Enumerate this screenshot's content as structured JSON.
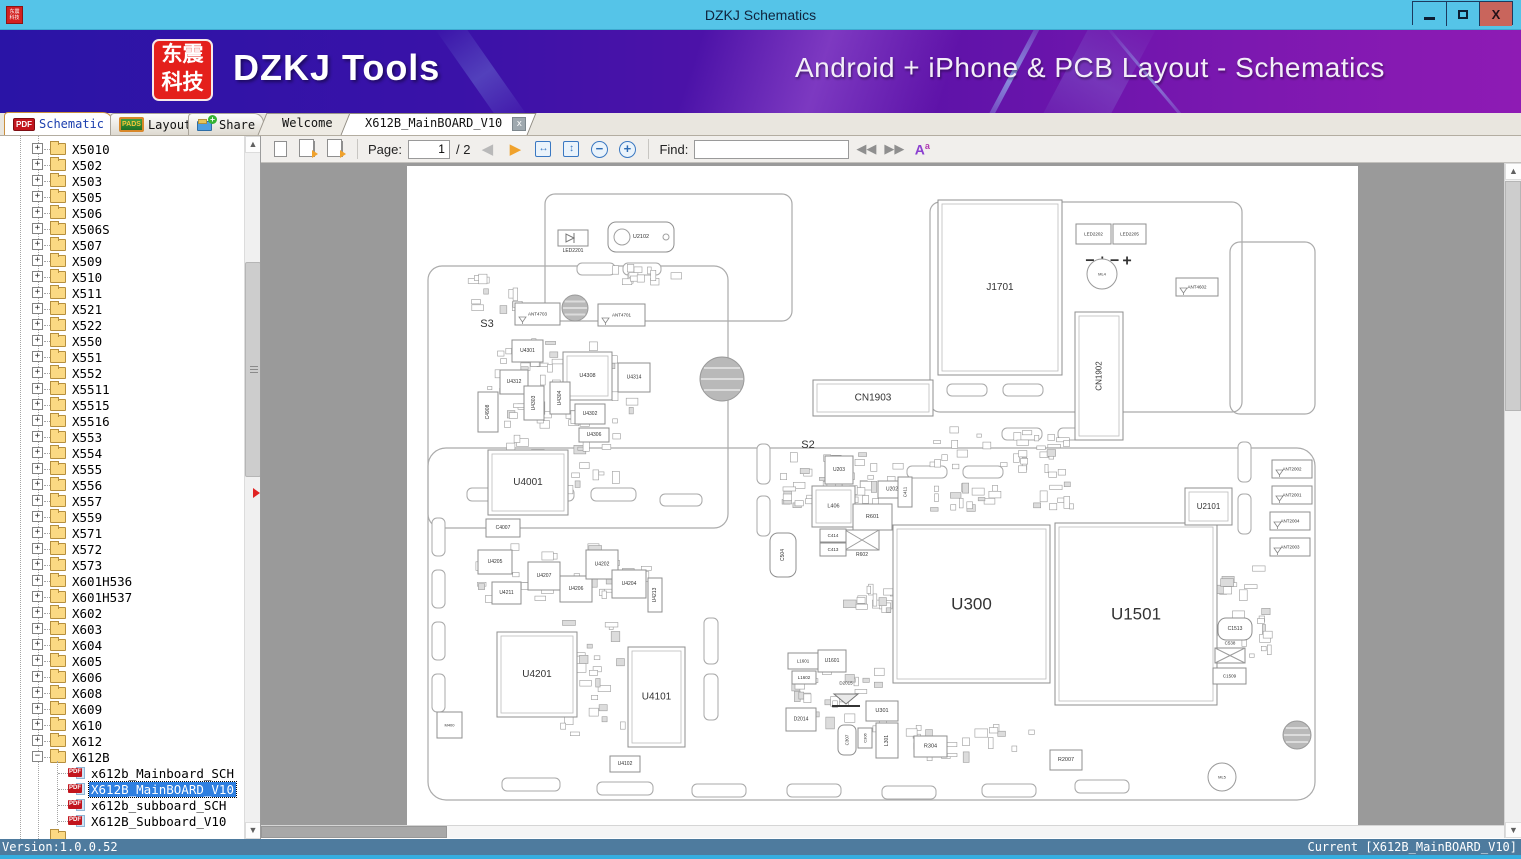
{
  "window": {
    "title": "DZKJ Schematics",
    "minimize": "–",
    "maximize": "□",
    "close": "X"
  },
  "banner": {
    "logo_line1": "东震",
    "logo_line2": "科技",
    "title": "DZKJ Tools",
    "subtitle": "Android + iPhone & PCB Layout - Schematics"
  },
  "nav_tabs": {
    "pdf_badge": "PDF",
    "schematic": "Schematic",
    "pads_badge": "PADS",
    "layout": "Layout",
    "share": "Share"
  },
  "doc_tabs": {
    "welcome": "Welcome",
    "active": "X612B_MainBOARD_V10",
    "close_glyph": "x"
  },
  "toolbar": {
    "page_label": "Page:",
    "page_value": "1",
    "page_total": "/ 2",
    "find_label": "Find:",
    "find_value": "",
    "fit_width_glyph": "↔",
    "fit_page_glyph": "↕",
    "zoom_out_glyph": "−",
    "zoom_in_glyph": "+",
    "prev_glyph": "◀",
    "next_glyph": "▶",
    "find_prev_glyph": "◀◀",
    "find_next_glyph": "▶▶",
    "case_glyph": "A"
  },
  "sidebar": {
    "folders": [
      "X5010",
      "X502",
      "X503",
      "X505",
      "X506",
      "X506S",
      "X507",
      "X509",
      "X510",
      "X511",
      "X521",
      "X522",
      "X550",
      "X551",
      "X552",
      "X5511",
      "X5515",
      "X5516",
      "X553",
      "X554",
      "X555",
      "X556",
      "X557",
      "X559",
      "X571",
      "X572",
      "X573",
      "X601H536",
      "X601H537",
      "X602",
      "X603",
      "X604",
      "X605",
      "X606",
      "X608",
      "X609",
      "X610",
      "X612",
      "X612B"
    ],
    "expanded": "X612B",
    "children": [
      "x612b_Mainboard_SCH",
      "X612B_MainBOARD_V10",
      "x612b_subboard_SCH",
      "X612B_Subboard_V10"
    ],
    "selected": "X612B_MainBOARD_V10"
  },
  "statusbar": {
    "version": "Version:1.0.0.52",
    "current": "Current [X612B_MainBOARD_V10]"
  },
  "colors": {
    "titlebar": "#55c4e8",
    "close_btn": "#c9655c",
    "selection": "#2e7fe0",
    "status": "#4e7b9e",
    "accent_strip": "#35aee0",
    "viewer_bg": "#9a9a9a",
    "logo_red": "#e4201c"
  },
  "board": {
    "outlines": [
      [
        138,
        28,
        247,
        127,
        10
      ],
      [
        21,
        100,
        300,
        262,
        14
      ],
      [
        523,
        36,
        312,
        210,
        10
      ],
      [
        823,
        76,
        85,
        172,
        10
      ],
      [
        21,
        282,
        887,
        352,
        18
      ]
    ],
    "slots": [
      [
        60,
        322,
        45,
        13
      ],
      [
        122,
        322,
        45,
        13
      ],
      [
        184,
        322,
        45,
        13
      ],
      [
        253,
        328,
        42,
        12
      ],
      [
        170,
        97,
        38,
        12
      ],
      [
        216,
        97,
        38,
        12
      ],
      [
        540,
        218,
        40,
        12
      ],
      [
        596,
        218,
        40,
        12
      ],
      [
        25,
        352,
        13,
        38
      ],
      [
        25,
        404,
        13,
        38
      ],
      [
        25,
        456,
        13,
        38
      ],
      [
        25,
        508,
        13,
        38
      ],
      [
        95,
        612,
        58,
        13
      ],
      [
        190,
        616,
        56,
        13
      ],
      [
        285,
        618,
        54,
        13
      ],
      [
        380,
        618,
        54,
        13
      ],
      [
        475,
        620,
        54,
        13
      ],
      [
        575,
        618,
        54,
        13
      ],
      [
        668,
        614,
        54,
        13
      ],
      [
        350,
        278,
        13,
        40
      ],
      [
        350,
        330,
        13,
        40
      ],
      [
        500,
        300,
        40,
        12
      ],
      [
        556,
        300,
        40,
        12
      ],
      [
        831,
        276,
        13,
        40
      ],
      [
        831,
        328,
        13,
        40
      ],
      [
        297,
        452,
        14,
        46
      ],
      [
        297,
        508,
        14,
        46
      ],
      [
        595,
        262,
        40,
        12
      ],
      [
        651,
        262,
        40,
        12
      ]
    ],
    "screws": [
      {
        "cx": 168,
        "cy": 142,
        "r": 13
      },
      {
        "cx": 315,
        "cy": 213,
        "r": 22
      },
      {
        "cx": 890,
        "cy": 569,
        "r": 14
      }
    ],
    "marks": [
      {
        "t": "ML4",
        "cx": 695,
        "cy": 108,
        "r": 15
      },
      {
        "t": "ML5",
        "cx": 815,
        "cy": 611,
        "r": 14
      }
    ],
    "ovals": [
      [
        551,
        62
      ],
      [
        634,
        88
      ],
      [
        551,
        170
      ],
      [
        634,
        170
      ]
    ],
    "labels": [
      {
        "t": "S3",
        "x": 80,
        "y": 158,
        "fs": 11
      },
      {
        "t": "S2",
        "x": 401,
        "y": 279,
        "fs": 11
      }
    ],
    "polarity": {
      "t": "−+−+",
      "x": 703,
      "y": 95,
      "fs": 16
    },
    "components": [
      {
        "t": "J1701",
        "x": 531,
        "y": 34,
        "w": 124,
        "h": 175,
        "fs": 10,
        "shape": "rect2"
      },
      {
        "t": "U300",
        "x": 486,
        "y": 359,
        "w": 157,
        "h": 158,
        "fs": 17,
        "shape": "rect2"
      },
      {
        "t": "U1501",
        "x": 648,
        "y": 357,
        "w": 162,
        "h": 182,
        "fs": 17,
        "shape": "rect2"
      },
      {
        "t": "U4001",
        "x": 81,
        "y": 284,
        "w": 80,
        "h": 65,
        "fs": 10,
        "shape": "rect2"
      },
      {
        "t": "U4201",
        "x": 90,
        "y": 466,
        "w": 80,
        "h": 85,
        "fs": 10,
        "shape": "rect2"
      },
      {
        "t": "U4101",
        "x": 221,
        "y": 481,
        "w": 57,
        "h": 100,
        "fs": 10,
        "shape": "rect2"
      },
      {
        "t": "CN1902",
        "x": 668,
        "y": 146,
        "w": 48,
        "h": 128,
        "fs": 8,
        "shape": "vrect2"
      },
      {
        "t": "CN1903",
        "x": 406,
        "y": 214,
        "w": 120,
        "h": 36,
        "fs": 10,
        "shape": "rect2"
      },
      {
        "t": "U2102",
        "x": 201,
        "y": 56,
        "w": 66,
        "h": 30,
        "fs": 5.5,
        "shape": "rrect"
      },
      {
        "t": "LED2201",
        "x": 151,
        "y": 64,
        "w": 30,
        "h": 16,
        "fs": 5,
        "shape": "led",
        "lp": "below"
      },
      {
        "t": "LED2202",
        "x": 669,
        "y": 58,
        "w": 35,
        "h": 20,
        "fs": 4.5,
        "shape": "rect"
      },
      {
        "t": "LED2205",
        "x": 706,
        "y": 58,
        "w": 33,
        "h": 20,
        "fs": 4.5,
        "shape": "rect"
      },
      {
        "t": "ANT4703",
        "x": 108,
        "y": 137,
        "w": 45,
        "h": 22,
        "fs": 4.5,
        "shape": "ant"
      },
      {
        "t": "ANT4701",
        "x": 191,
        "y": 138,
        "w": 47,
        "h": 22,
        "fs": 4.5,
        "shape": "ant"
      },
      {
        "t": "ANT4602",
        "x": 769,
        "y": 112,
        "w": 42,
        "h": 18,
        "fs": 4.5,
        "shape": "ant"
      },
      {
        "t": "ANT2002",
        "x": 865,
        "y": 294,
        "w": 40,
        "h": 18,
        "fs": 4.5,
        "shape": "ant"
      },
      {
        "t": "ANT2001",
        "x": 865,
        "y": 320,
        "w": 40,
        "h": 18,
        "fs": 4.5,
        "shape": "ant"
      },
      {
        "t": "ANT2004",
        "x": 863,
        "y": 346,
        "w": 40,
        "h": 18,
        "fs": 4.5,
        "shape": "ant"
      },
      {
        "t": "ANT2003",
        "x": 863,
        "y": 372,
        "w": 40,
        "h": 18,
        "fs": 4.5,
        "shape": "ant"
      },
      {
        "t": "U2101",
        "x": 778,
        "y": 322,
        "w": 47,
        "h": 37,
        "fs": 8,
        "shape": "rect2"
      },
      {
        "t": "U4301",
        "x": 105,
        "y": 174,
        "w": 31,
        "h": 22,
        "fs": 5,
        "shape": "rect"
      },
      {
        "t": "U4312",
        "x": 93,
        "y": 204,
        "w": 28,
        "h": 24,
        "fs": 5,
        "shape": "rect"
      },
      {
        "t": "U4308",
        "x": 156,
        "y": 186,
        "w": 49,
        "h": 48,
        "fs": 5.5,
        "shape": "rect2"
      },
      {
        "t": "U4314",
        "x": 211,
        "y": 197,
        "w": 32,
        "h": 29,
        "fs": 5,
        "shape": "rect"
      },
      {
        "t": "U4303",
        "x": 117,
        "y": 220,
        "w": 20,
        "h": 34,
        "fs": 5,
        "shape": "vrect"
      },
      {
        "t": "U4304",
        "x": 143,
        "y": 216,
        "w": 20,
        "h": 32,
        "fs": 5,
        "shape": "vrect"
      },
      {
        "t": "U4302",
        "x": 168,
        "y": 238,
        "w": 30,
        "h": 20,
        "fs": 5,
        "shape": "rect"
      },
      {
        "t": "U4306",
        "x": 172,
        "y": 262,
        "w": 30,
        "h": 14,
        "fs": 5,
        "shape": "rect"
      },
      {
        "t": "C4908",
        "x": 71,
        "y": 226,
        "w": 20,
        "h": 40,
        "fs": 5,
        "shape": "vrect"
      },
      {
        "t": "C4007",
        "x": 79,
        "y": 353,
        "w": 34,
        "h": 18,
        "fs": 5,
        "shape": "rect"
      },
      {
        "t": "U4205",
        "x": 71,
        "y": 384,
        "w": 34,
        "h": 24,
        "fs": 5,
        "shape": "rect"
      },
      {
        "t": "U4207",
        "x": 121,
        "y": 396,
        "w": 32,
        "h": 28,
        "fs": 5,
        "shape": "rect"
      },
      {
        "t": "U4211",
        "x": 85,
        "y": 416,
        "w": 29,
        "h": 22,
        "fs": 5,
        "shape": "rect"
      },
      {
        "t": "U4206",
        "x": 153,
        "y": 410,
        "w": 32,
        "h": 26,
        "fs": 5,
        "shape": "rect"
      },
      {
        "t": "U4202",
        "x": 179,
        "y": 384,
        "w": 32,
        "h": 29,
        "fs": 5,
        "shape": "rect"
      },
      {
        "t": "U4204",
        "x": 205,
        "y": 404,
        "w": 34,
        "h": 28,
        "fs": 5,
        "shape": "rect"
      },
      {
        "t": "U4213",
        "x": 241,
        "y": 412,
        "w": 14,
        "h": 34,
        "fs": 5,
        "shape": "vrect"
      },
      {
        "t": "U4102",
        "x": 203,
        "y": 590,
        "w": 30,
        "h": 16,
        "fs": 5,
        "shape": "rect"
      },
      {
        "t": "M400",
        "x": 30,
        "y": 546,
        "w": 25,
        "h": 26,
        "fs": 4,
        "shape": "rect"
      },
      {
        "t": "U203",
        "x": 418,
        "y": 290,
        "w": 28,
        "h": 28,
        "fs": 5,
        "shape": "rect"
      },
      {
        "t": "L406",
        "x": 405,
        "y": 320,
        "w": 43,
        "h": 41,
        "fs": 5.5,
        "shape": "rect2"
      },
      {
        "t": "R601",
        "x": 446,
        "y": 338,
        "w": 39,
        "h": 26,
        "fs": 5.5,
        "shape": "rect"
      },
      {
        "t": "R602",
        "x": 438,
        "y": 364,
        "w": 34,
        "h": 20,
        "fs": 5,
        "shape": "bowtie",
        "lp": "below"
      },
      {
        "t": "C414",
        "x": 413,
        "y": 363,
        "w": 26,
        "h": 13,
        "fs": 4.5,
        "shape": "rect"
      },
      {
        "t": "C413",
        "x": 413,
        "y": 377,
        "w": 26,
        "h": 13,
        "fs": 4.5,
        "shape": "rect"
      },
      {
        "t": "C504",
        "x": 363,
        "y": 367,
        "w": 26,
        "h": 44,
        "fs": 5,
        "shape": "vrrect"
      },
      {
        "t": "U202",
        "x": 471,
        "y": 315,
        "w": 28,
        "h": 17,
        "fs": 5,
        "shape": "rect"
      },
      {
        "t": "C411",
        "x": 491,
        "y": 311,
        "w": 14,
        "h": 30,
        "fs": 4.5,
        "shape": "vrect"
      },
      {
        "t": "L1601",
        "x": 381,
        "y": 487,
        "w": 30,
        "h": 16,
        "fs": 4.5,
        "shape": "rect"
      },
      {
        "t": "U1601",
        "x": 411,
        "y": 484,
        "w": 28,
        "h": 22,
        "fs": 5,
        "shape": "rect"
      },
      {
        "t": "L1602",
        "x": 385,
        "y": 505,
        "w": 24,
        "h": 13,
        "fs": 4.5,
        "shape": "rect"
      },
      {
        "t": "D2015",
        "x": 425,
        "y": 522,
        "w": 28,
        "h": 22,
        "fs": 4.5,
        "shape": "diode",
        "lp": "above"
      },
      {
        "t": "U301",
        "x": 459,
        "y": 535,
        "w": 32,
        "h": 20,
        "fs": 5.5,
        "shape": "rect"
      },
      {
        "t": "D2014",
        "x": 379,
        "y": 542,
        "w": 30,
        "h": 23,
        "fs": 5,
        "shape": "rect"
      },
      {
        "t": "C307",
        "x": 431,
        "y": 559,
        "w": 18,
        "h": 30,
        "fs": 4.5,
        "shape": "vrrect"
      },
      {
        "t": "C306",
        "x": 451,
        "y": 562,
        "w": 14,
        "h": 20,
        "fs": 4,
        "shape": "vrect"
      },
      {
        "t": "L301",
        "x": 469,
        "y": 557,
        "w": 22,
        "h": 35,
        "fs": 5,
        "shape": "vrect"
      },
      {
        "t": "R304",
        "x": 507,
        "y": 570,
        "w": 33,
        "h": 21,
        "fs": 5.5,
        "shape": "rect"
      },
      {
        "t": "R2007",
        "x": 643,
        "y": 584,
        "w": 32,
        "h": 20,
        "fs": 5.5,
        "shape": "rect"
      },
      {
        "t": "C1513",
        "x": 811,
        "y": 452,
        "w": 34,
        "h": 22,
        "fs": 5,
        "shape": "rrect"
      },
      {
        "t": "C538",
        "x": 808,
        "y": 482,
        "w": 30,
        "h": 15,
        "fs": 4.5,
        "shape": "bowtie",
        "lp": "above"
      },
      {
        "t": "C1509",
        "x": 806,
        "y": 502,
        "w": 33,
        "h": 16,
        "fs": 4.5,
        "shape": "rect"
      }
    ],
    "clusters": [
      [
        75,
        168,
        165,
        95,
        55,
        1
      ],
      [
        78,
        266,
        140,
        66,
        35,
        2
      ],
      [
        65,
        375,
        190,
        62,
        38,
        3
      ],
      [
        152,
        452,
        68,
        118,
        28,
        4
      ],
      [
        372,
        286,
        126,
        58,
        40,
        5
      ],
      [
        520,
        255,
        148,
        92,
        55,
        6
      ],
      [
        368,
        480,
        112,
        92,
        30,
        7
      ],
      [
        196,
        95,
        92,
        24,
        12,
        8
      ],
      [
        640,
        490,
        150,
        34,
        24,
        9
      ],
      [
        798,
        395,
        68,
        100,
        28,
        10
      ],
      [
        490,
        556,
        140,
        42,
        20,
        11
      ],
      [
        60,
        108,
        58,
        40,
        12,
        12
      ],
      [
        430,
        418,
        60,
        30,
        14,
        13
      ]
    ]
  }
}
